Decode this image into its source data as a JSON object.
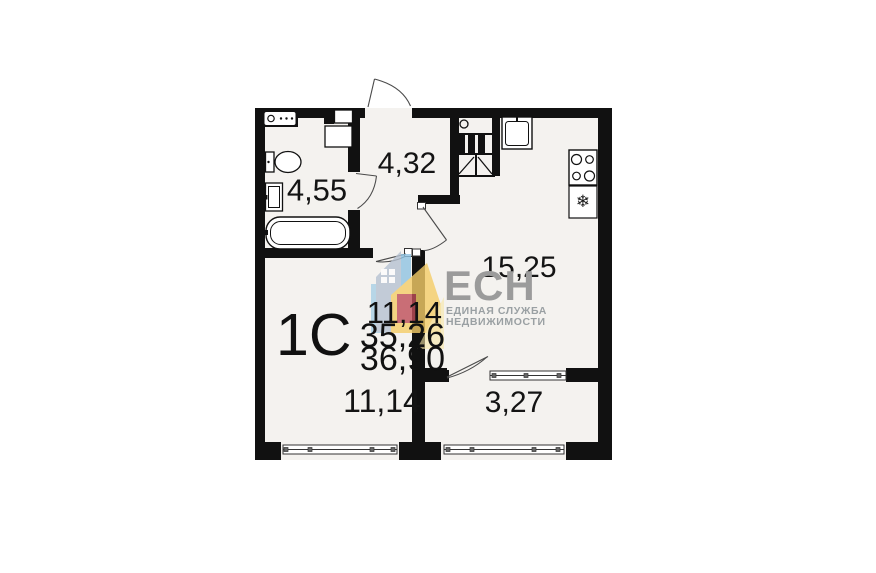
{
  "plan": {
    "unit": {
      "type": "1С",
      "living_area": "11,14",
      "area": "35,26",
      "total_area": "36,90"
    },
    "rooms": [
      {
        "name": "bathroom",
        "area": "4,55"
      },
      {
        "name": "hallway",
        "area": "4,32"
      },
      {
        "name": "kitchen",
        "area": "15,25"
      },
      {
        "name": "living-room",
        "area": "11,14"
      },
      {
        "name": "balcony",
        "area": "3,27"
      }
    ],
    "icons": {
      "fridge_snowflake": "❄"
    },
    "colors": {
      "wall": "#111111",
      "floor": "#f4f2ef",
      "logo_gray": "#9b9b9b",
      "house_slate": "#b6c2d2",
      "house_light_blue": "#a9d0e6",
      "house_blue": "#8fc3e2",
      "house_yellow": "#f5cd68",
      "house_pale_yellow": "#f7e6a6",
      "house_red": "#bf4e59"
    }
  },
  "logo": {
    "name": "ЕСН",
    "tagline": [
      "ЕДИНАЯ СЛУЖБА",
      "НЕДВИЖИМОСТИ"
    ]
  }
}
